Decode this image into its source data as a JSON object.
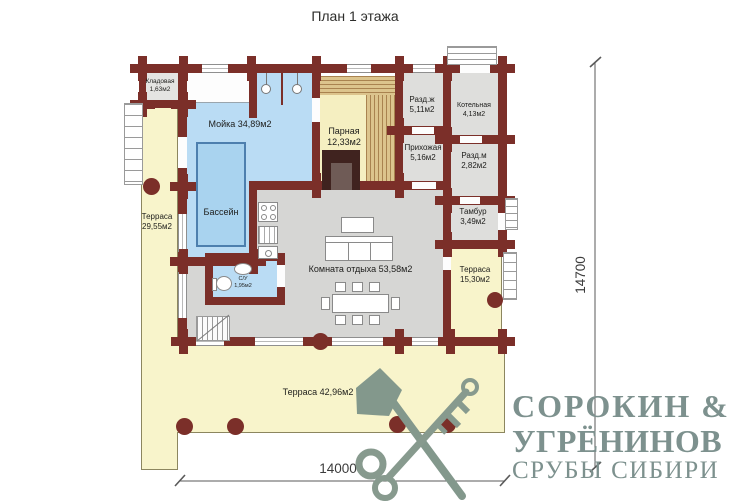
{
  "title": "План 1 этажа",
  "rooms": {
    "kladovaya": {
      "name": "Кладовая",
      "area": "1,63м2"
    },
    "moyka": {
      "label": "Мойка 34,89м2"
    },
    "parnaya": {
      "name": "Парная",
      "area": "12,33м2"
    },
    "razd_zh": {
      "name": "Разд.ж",
      "area": "5,11м2"
    },
    "kotelnaya": {
      "name": "Котельная",
      "area": "4,13м2"
    },
    "prihozhaya": {
      "name": "Прихожая",
      "area": "5,16м2"
    },
    "razd_m": {
      "name": "Разд.м",
      "area": "2,82м2"
    },
    "tambur": {
      "name": "Тамбур",
      "area": "3,49м2"
    },
    "bassein": {
      "label": "Бассейн"
    },
    "su": {
      "name": "С/У",
      "area": "1,95м2"
    },
    "lounge": {
      "label": "Комната отдыха 53,58м2"
    },
    "terrace_left": {
      "name": "Терраса",
      "area": "29,55м2"
    },
    "terrace_right": {
      "name": "Терраса",
      "area": "15,30м2"
    },
    "terrace_bottom": {
      "label": "Терраса 42,96м2"
    }
  },
  "dimensions": {
    "bottom": "14000",
    "right": "14700"
  },
  "logo": {
    "line1": "СОРОКИН &",
    "line2": "УГРЁНИНОВ",
    "line3": "СРУБЫ СИБИРИ"
  },
  "colors": {
    "wall": "#7b2f29",
    "terrace": "#f8f4cb",
    "wet_room": "#badcf4",
    "pool": "#a9d3ef",
    "room_gray": "#dededc",
    "lounge_gray": "#d6d6d4",
    "sauna_wood": "#dcc48d",
    "logo_text": "#7d918e",
    "logo_graphic": "#879a8e"
  }
}
